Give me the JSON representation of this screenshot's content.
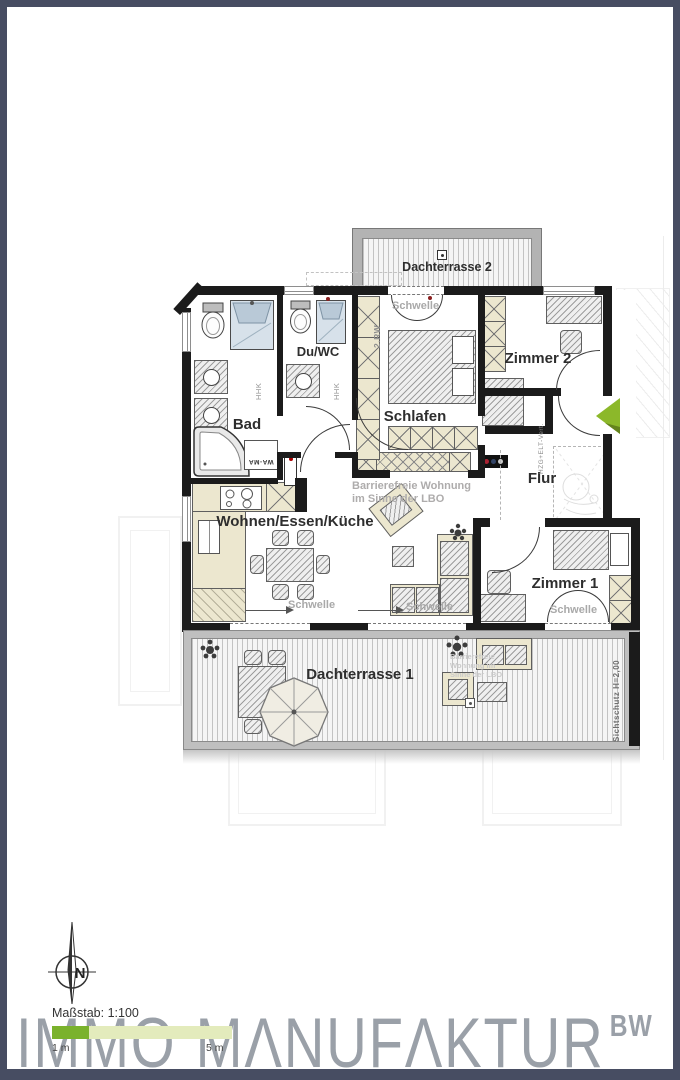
{
  "plan": {
    "rooms": [
      {
        "id": "dachterrasse-2",
        "label": "Dachterrasse 2"
      },
      {
        "id": "bad",
        "label": "Bad"
      },
      {
        "id": "du-wc",
        "label": "Du/WC"
      },
      {
        "id": "schlafen",
        "label": "Schlafen"
      },
      {
        "id": "zimmer-2",
        "label": "Zimmer 2"
      },
      {
        "id": "flur",
        "label": "Flur"
      },
      {
        "id": "wohnen-essen-kueche",
        "label": "Wohnen/Essen/Küche"
      },
      {
        "id": "zimmer-1",
        "label": "Zimmer 1"
      },
      {
        "id": "dachterrasse-1",
        "label": "Dachterrasse 1"
      }
    ],
    "notes": {
      "accessibility_line1": "Barrierefreie Wohnung",
      "accessibility_line2": "im Sinne der LBO",
      "threshold": "Schwelle",
      "rw": "2.RW",
      "hhk": "HHK",
      "washer": "WA-MA",
      "hzg": "HZG+ELT-Vert.",
      "privacy_screen": "Sichtschutz H=2,00",
      "terrace_watermark_line1": "Barrierefreie",
      "terrace_watermark_line2": "Wohnung im",
      "terrace_watermark_line3": "Sinne der LBO"
    },
    "colors": {
      "frame": "#474d62",
      "wall": "#1b1b1b",
      "cabinet_cream": "#ece7cf",
      "shower_blue": "#d7e1ea",
      "entrance_arrow_green": "#8cb82a",
      "note_gray": "#a9a9a9",
      "logo_gray": "#9aa0a8",
      "scale_green_dark": "#7ab22c",
      "scale_green_light": "#e3ebbc"
    }
  },
  "footer": {
    "scale_label": "Maßstab: 1:100",
    "scale_tick_1m": "1 m",
    "scale_tick_5m": "5 m",
    "north_label": "N",
    "logo_word1": "IMMO",
    "logo_word2": "MΛNUFΛKTUR",
    "logo_suffix": "BW"
  }
}
